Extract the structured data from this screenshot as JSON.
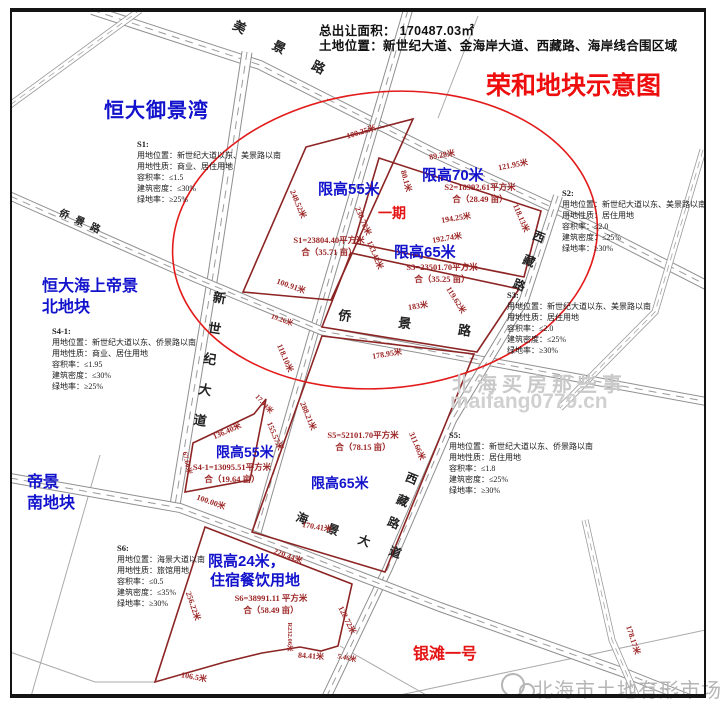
{
  "colors": {
    "plot_outline": "#8c2424",
    "dimension_text": "#9c2525",
    "height_label_blue": "#1212cc",
    "title_red": "#ee0e0e",
    "phase_red": "#e51414",
    "road_gray": "#8f8f8f",
    "watermark_gray": "#c3c3c3"
  },
  "header": {
    "total_area": "总出让面积：  170487.03㎡",
    "location": "土地位置：新世纪大道、金海岸大道、西藏路、海岸线合围区域",
    "title": "荣和地块示意图"
  },
  "labels": {
    "hengda_yujingwan": "恒大御景湾",
    "hengda_haishang_line1": "恒大海上帝景",
    "hengda_haishang_line2": "北地块",
    "dijing_line1": "帝景",
    "dijing_line2": "南地块",
    "yintan": "银滩一号",
    "phase": "一期",
    "watermark_center_line1": "北海买房那些事",
    "watermark_center_line2": "maifang0779.cn",
    "watermark_bottom": "北海市土地有形市场"
  },
  "height_limits": {
    "circle_west": "限高55米",
    "circle_northeast": "限高70米",
    "circle_south": "限高65米",
    "mid_west": "限高55米",
    "mid_east": "限高65米",
    "south_line1": "限高24米，",
    "south_line2": "住宿餐饮用地"
  },
  "roads": {
    "meijing_road": "美 景 路",
    "xinshiji_avenue": "新世纪大道",
    "qiaojing_road": "侨 景 路",
    "qiaojing_road_west": "侨景路",
    "xizang_road_north": "西藏路",
    "xizang_road_south": "西藏路",
    "haijing_avenue": "海 景 大 道"
  },
  "parcels": {
    "s1": {
      "id": "S1:",
      "location": "用地位置：新世纪大道以东、美景路以南",
      "nature": "用地性质：商业、居住用地",
      "far": "容积率：≤1.5",
      "density": "建筑密度：≤30%",
      "green": "绿地率：≥25%",
      "area": "S1=23804.40平方米",
      "mu": "合（35.71 亩）"
    },
    "s2": {
      "id": "S2:",
      "location": "用地位置：新世纪大道以东、美景路以南",
      "nature": "用地性质：居住用地",
      "far": "容积率：≤2.0",
      "density": "建筑密度：≤25%",
      "green": "绿地率：≥30%",
      "area": "S2=18992.61平方米",
      "mu": "合（28.49 亩）"
    },
    "s3": {
      "id": "S3:",
      "location": "用地位置：新世纪大道以东、美景路以南",
      "nature": "用地性质：居住用地",
      "far": "容积率：≤2.0",
      "density": "建筑密度：≤25%",
      "green": "绿地率：≥30%",
      "area": "S3=23501.70平方米",
      "mu": "合（35.25 亩）"
    },
    "s4_1": {
      "id": "S4-1:",
      "location": "用地位置：新世纪大道以东、侨景路以南",
      "nature": "用地性质：商业、居住用地",
      "far": "容积率：≤1.95",
      "density": "建筑密度：≤30%",
      "green": "绿地率：≥25%",
      "area": "S4-1=13095.51平方米",
      "mu": "合（19.64 亩）"
    },
    "s5": {
      "id": "S5:",
      "location": "用地位置：新世纪大道以东、侨景路以南",
      "nature": "用地性质：居住用地",
      "far": "容积率：≤1.8",
      "density": "建筑密度：≤25%",
      "green": "绿地率：≥30%",
      "area": "S5=52101.70平方米",
      "mu": "合（78.15 亩）"
    },
    "s6": {
      "id": "S6:",
      "location": "用地位置：海景大道以南",
      "nature": "用地性质：旅馆用地",
      "far": "容积率：≤0.5",
      "density": "建筑密度：≤35%",
      "green": "绿地率：≥30%",
      "area": "S6=38991.11 平方米",
      "mu": "合（58.49 亩）"
    }
  },
  "dims": [
    "100.25米",
    "89.28米",
    "121.95米",
    "248.52米",
    "230.78米",
    "80.1米",
    "194.25米",
    "192.74米",
    "118.13米",
    "133.42米",
    "100.91米",
    "119.62米",
    "19.26米",
    "183米",
    "178.95米",
    "118.10米",
    "17.44米",
    "136.40米",
    "155.57米",
    "288.21米",
    "311.66米",
    "67.66米",
    "100.00米",
    "170.41米",
    "220.44米",
    "256.22米",
    "R232.06米",
    "84.41米",
    "5.46米",
    "128.72米",
    "106.5米",
    "178.17米"
  ]
}
